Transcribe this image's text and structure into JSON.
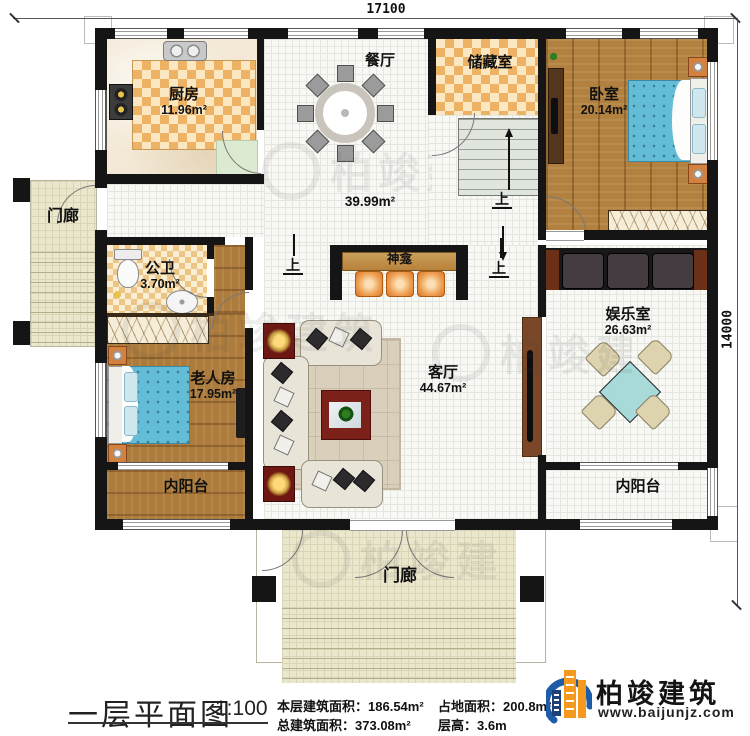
{
  "dimensions": {
    "top": "17100",
    "right": "14000"
  },
  "rooms": {
    "kitchen": {
      "name": "厨房",
      "area": "11.96m²"
    },
    "dining": {
      "name": "餐厅",
      "area": "39.99m²"
    },
    "storage": {
      "name": "储藏室"
    },
    "bedroom": {
      "name": "卧室",
      "area": "20.14m²"
    },
    "porch_left": {
      "name": "门廊"
    },
    "bathroom": {
      "name": "公卫",
      "area": "3.70m²"
    },
    "elder_room": {
      "name": "老人房",
      "area": "17.95m²"
    },
    "balcony_left": {
      "name": "内阳台"
    },
    "living": {
      "name": "客厅",
      "area": "44.67m²"
    },
    "shrine": {
      "name": "神龛"
    },
    "entertainment": {
      "name": "娱乐室",
      "area": "26.63m²"
    },
    "balcony_right": {
      "name": "内阳台"
    },
    "porch_bottom": {
      "name": "门廊"
    }
  },
  "stairs": {
    "up": "上"
  },
  "steps": {
    "left_up": "上",
    "right_up": "上"
  },
  "title_block": {
    "title": "一层平面图",
    "scale": "1:100",
    "items": [
      {
        "label": "本层建筑面积：",
        "value": "186.54m²"
      },
      {
        "label": "总建筑面积：",
        "value": "373.08m²"
      },
      {
        "label": "占地面积：",
        "value": "200.8m²"
      },
      {
        "label": "层高：",
        "value": "3.6m"
      }
    ]
  },
  "logo": {
    "company": "柏竣建筑",
    "website": "www.baijunjz.com"
  },
  "watermark": {
    "text": "柏竣建筑"
  }
}
